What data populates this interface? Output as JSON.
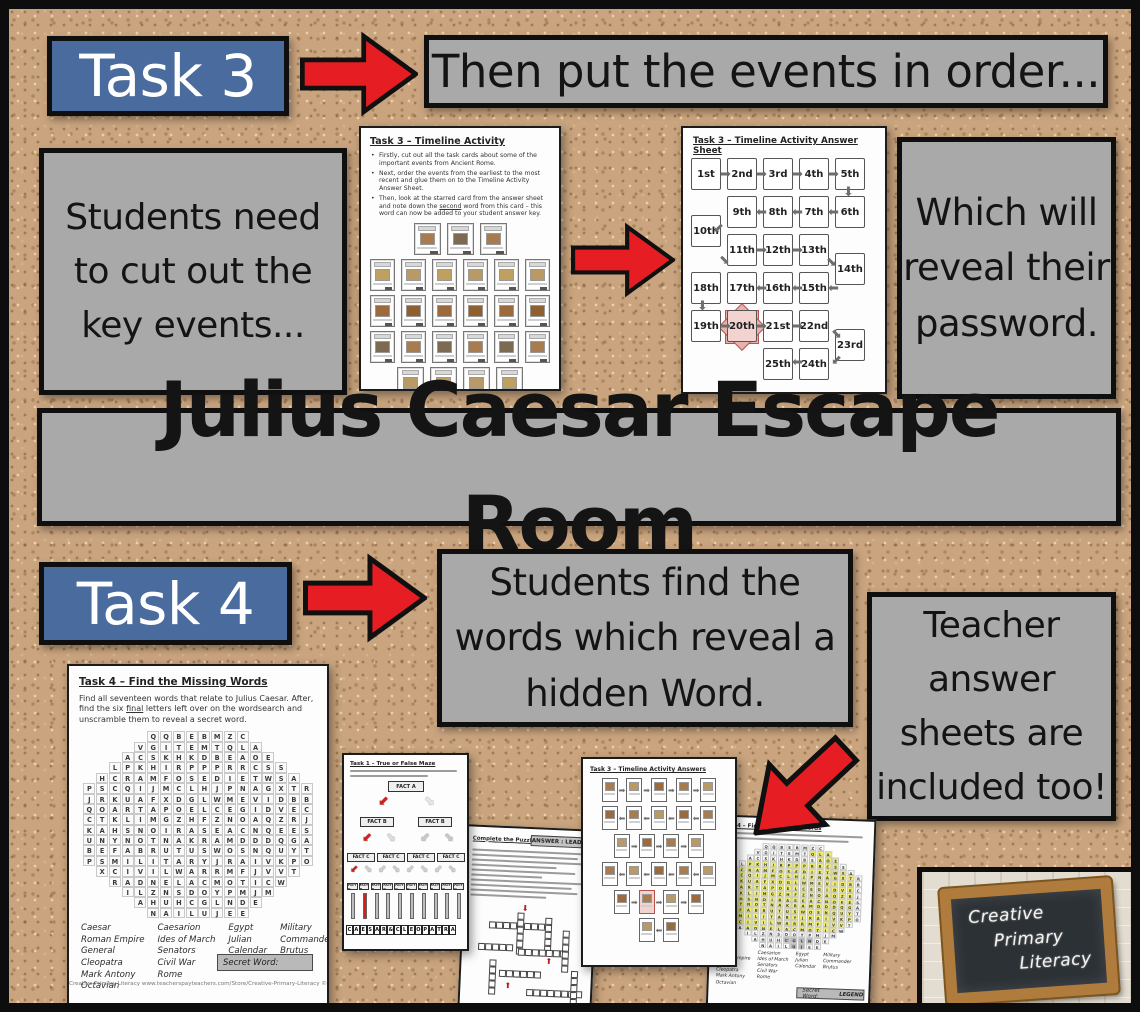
{
  "colors": {
    "cork": "#c9a47e",
    "banner_blue": "#4a6b9d",
    "note_gray": "#a9a9a9",
    "arrow_red": "#e61e23",
    "star_pink": "#e5b2ae",
    "highlight_yellow": "#f0ee6a"
  },
  "main_title": "Julius Caesar Escape Room",
  "task3": {
    "banner_label": "Task 3",
    "then_banner": "Then put the events in order...",
    "left_note": "Students need to cut out the key events...",
    "right_note": "Which will reveal their password.",
    "worksheet": {
      "title": "Task 3 – Timeline Activity",
      "bullet1": "Firstly, cut out all the task cards about some of the important events from Ancient Rome.",
      "bullet2": "Next, order the events from the earliest to the most recent and glue them on to the Timeline Activity Answer Sheet.",
      "bullet3_pre": "Then, look at the starred card from the answer sheet and note down the ",
      "bullet3_u": "second",
      "bullet3_post": " word from this card – this word can now be added to your student answer key.",
      "card_rows": [
        3,
        6,
        6,
        6,
        4
      ]
    },
    "answer_sheet": {
      "title": "Task 3 – Timeline Activity Answer Sheet",
      "ordinals": [
        "1st",
        "2nd",
        "3rd",
        "4th",
        "5th",
        "6th",
        "7th",
        "8th",
        "9th",
        "10th",
        "11th",
        "12th",
        "13th",
        "14th",
        "15th",
        "16th",
        "17th",
        "18th",
        "19th",
        "20th",
        "21st",
        "22nd",
        "23rd",
        "24th",
        "25th"
      ],
      "starred": "20th"
    }
  },
  "task4": {
    "banner_label": "Task 4",
    "note": "Students find the words which reveal a hidden Word.",
    "teacher_note": "Teacher answer sheets are included too!",
    "worksheet": {
      "title": "Task 4 – Find the Missing Words",
      "instr_pre": "Find all seventeen words that relate to Julius Caesar. After, find the six ",
      "instr_u": "final",
      "instr_post": " letters left over on the wordsearch and unscramble them to reveal a secret word.",
      "grid": [
        "QQBEBMZC",
        "VGITEMTQLA",
        "ACSKHKDBEAOE",
        "LPKHIRPPPRRCSS",
        "HCRAMFOSEDIETWSA",
        "PSCQIJMCLHJPNAGXTR",
        "JRKUAFXDGLWMEVIDBB",
        "QOARTAPOELCEGIDVEC",
        "CTKLIMGZHFZNOAQZRJ",
        "KAHSNOIRASEACNQEES",
        "UNYNOTNAKRAMDDDQGA",
        "BEFABRUTUSWOSNQUYT",
        "PSMILITARYJRAIVKPO",
        "XCIVILWARRMFJVVT",
        "RADNELACMOTICW",
        "ILZNSDOYPMJM",
        "AHUHCGLNDE",
        "NAILUJEE"
      ],
      "word_columns": [
        [
          "Caesar",
          "Roman Empire",
          "General",
          "Cleopatra",
          "Mark Antony",
          "Octavian"
        ],
        [
          "Caesarion",
          "Ides of March",
          "Senators",
          "Civil War",
          "Rome"
        ],
        [
          "Egypt",
          "Julian",
          "Calendar"
        ],
        [
          "Military",
          "Commander",
          "Brutus"
        ]
      ],
      "secret_label": "Secret Word:",
      "footer": "Creative Primary Literacy www.teacherspayteachers.com/Store/Creative-Primary-Literacy ©"
    }
  },
  "previews": {
    "maze": {
      "title": "Task 1 – True or False Maze",
      "fact_a": "FACT A",
      "fact_b": "FACT B",
      "fact_c": "FACT C",
      "fact_d": "FACT D",
      "letters": "CAESAR&CLEOPATRA"
    },
    "crossword": {
      "title": "Complete the Puzzle Answers",
      "answer_label": "ANSWER : LEADER"
    },
    "timeline_answers": {
      "title": "Task 3 – Timeline Activity Answers"
    },
    "wordsearch_answers": {
      "title": "Task 4 – Find the Missing Words",
      "secret_label": "Secret Word:",
      "secret_value": "LEGEND"
    }
  },
  "logo": {
    "line1": "Creative",
    "line2": "Primary",
    "line3": "Literacy"
  }
}
